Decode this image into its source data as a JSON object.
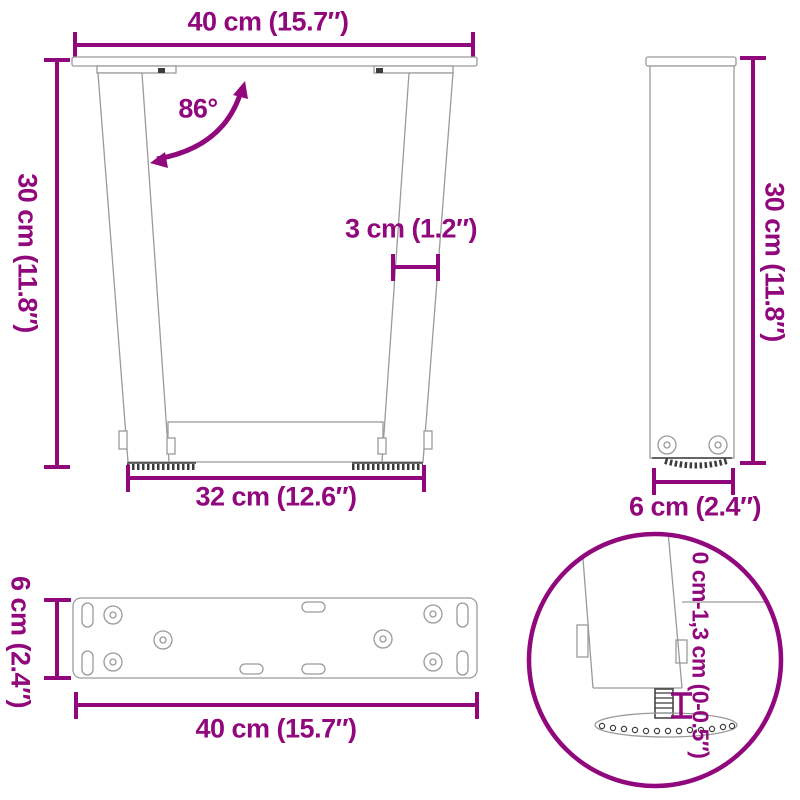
{
  "colors": {
    "accent": "#90087C",
    "outline_gray": "#9a9a9a",
    "dark": "#3c3c3c",
    "background": "#ffffff"
  },
  "views": {
    "front": {
      "top_width": "40 cm (15.7″)",
      "height": "30 cm (11.8″)",
      "angle": "86°",
      "leg_thickness": "3 cm (1.2″)",
      "bottom_width": "32 cm (12.6″)"
    },
    "side": {
      "height": "30 cm (11.8″)",
      "depth": "6 cm (2.4″)"
    },
    "plate": {
      "depth": "6 cm (2.4″)",
      "width": "40 cm (15.7″)"
    },
    "detail": {
      "foot_adjustment": "0 cm-1,3 cm (0-0.5″)"
    }
  }
}
